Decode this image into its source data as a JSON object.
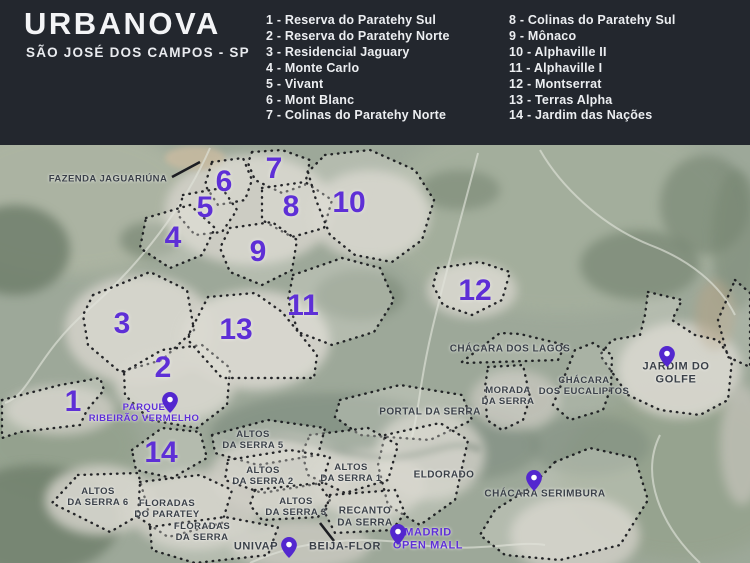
{
  "header": {
    "title": "URBANOVA",
    "subtitle": "SÃO JOSÉ DOS CAMPOS - SP",
    "legend_col1": [
      "1 - Reserva do Paratehy Sul",
      "2 - Reserva do Paratehy Norte",
      "3 - Residencial Jaguary",
      "4 - Monte Carlo",
      "5 - Vivant",
      "6 - Mont Blanc",
      "7 - Colinas do Paratehy Norte"
    ],
    "legend_col2": [
      "8 - Colinas do Paratehy Sul",
      "9 - Mônaco",
      "10 - Alphaville II",
      "11 - Alphaville I",
      "12 - Montserrat",
      "13 - Terras Alpha",
      "14 - Jardim das Nações"
    ]
  },
  "map": {
    "numbers": [
      "1",
      "2",
      "3",
      "4",
      "5",
      "6",
      "7",
      "8",
      "9",
      "10",
      "11",
      "12",
      "13",
      "14"
    ],
    "labels": {
      "fazenda_jaguariuna": "FAZENDA JAGUARIÚNA",
      "parque_ribeirao_vermelho": "PARQUE\nRIBEIRÃO VERMELHO",
      "chacara_dos_lagos": "CHÁCARA DOS LAGOS",
      "jardim_do_golfe": "JARDIM DO GOLFE",
      "chacara_dos_eucaliptos": "CHÁCARA\nDOS EUCALIPTOS",
      "morada_da_serra": "MORADA\nDA SERRA",
      "portal_da_serra": "PORTAL DA SERRA",
      "altos_da_serra_5": "ALTOS\nDA SERRA 5",
      "eldorado": "ELDORADO",
      "altos_da_serra_1": "ALTOS\nDA SERRA 1",
      "altos_da_serra_2": "ALTOS\nDA SERRA 2",
      "altos_da_serra_3": "ALTOS\nDA SERRA 3",
      "altos_da_serra_6": "ALTOS\nDA SERRA 6",
      "floradas_do_paratey": "FLORADAS\nDO PARATEY",
      "floradas_da_serra": "FLORADAS\nDA SERRA",
      "recanto_da_serra": "RECANTO\nDA SERRA",
      "chacara_serimbura": "CHÁCARA SERIMBURA",
      "univap": "UNIVAP",
      "beija_flor": "BEIJA-FLOR",
      "madrid_open_mall": "MADRID\nOPEN MALL"
    },
    "icons": {
      "map_pin": "teardrop-location-marker"
    },
    "colors": {
      "header_bg": "#23272e",
      "header_text": "#f3f4f6",
      "accent_purple": "#5e2fd6",
      "label_dark": "#3a4048",
      "outline_dots": "#17181c",
      "map_base_green": "#9da899"
    }
  }
}
